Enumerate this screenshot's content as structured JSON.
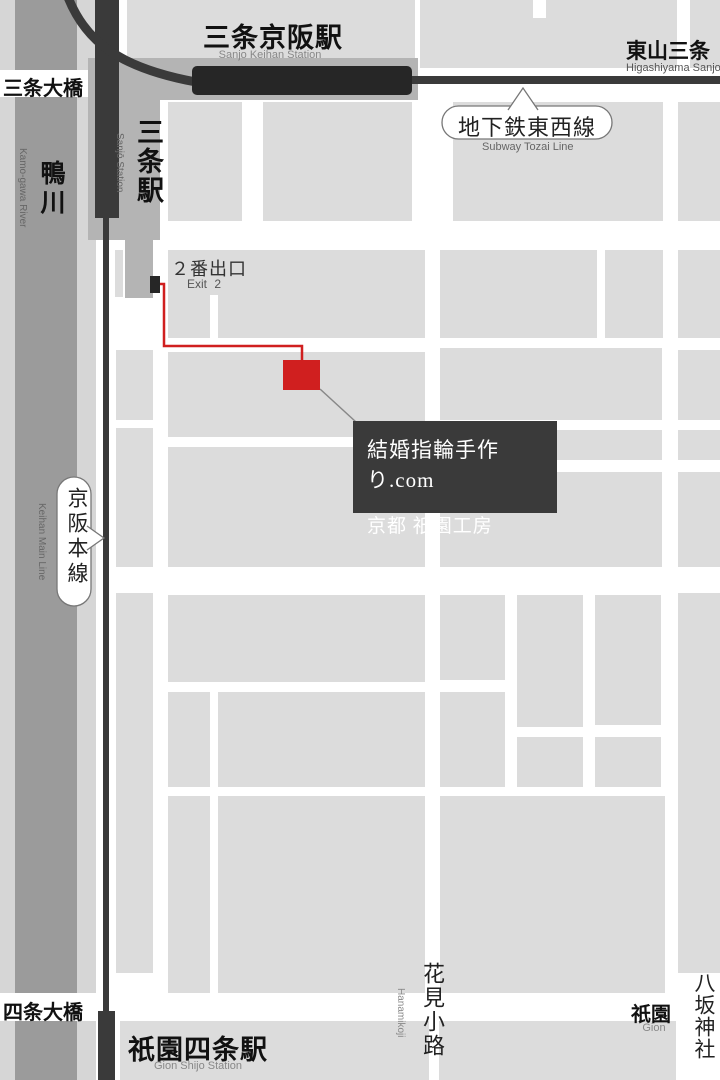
{
  "labels": {
    "sanjo_keihan_station": {
      "ja": "三条京阪駅",
      "en": "Sanjo Keihan Station"
    },
    "higashiyama_sanjo": {
      "ja": "東山三条",
      "en": "Higashiyama Sanjo"
    },
    "sanjo_ohashi_bridge": {
      "ja": "三条大橋"
    },
    "kamo_river": {
      "ja": "鴨川",
      "en": "Kamo-gawa River"
    },
    "sanjo_station": {
      "ja": "三条駅",
      "en": "Sanjō Station"
    },
    "subway_tozai_line": {
      "ja": "地下鉄東西線",
      "en": "Subway Tozai Line"
    },
    "exit_2": {
      "ja": "２番出口",
      "en": "Exit 2"
    },
    "keihan_main_line": {
      "ja": "京阪本線",
      "en": "Keihan Main Line"
    },
    "hanamikoji": {
      "ja": "花見小路",
      "en": "Hanamikoji"
    },
    "gion": {
      "ja": "祇園",
      "en": "Gion"
    },
    "yasaka_shrine": {
      "ja": "八坂神社"
    },
    "shijo_ohashi_bridge": {
      "ja": "四条大橋"
    },
    "gion_shijo_station": {
      "ja": "祇園四条駅",
      "en": "Gion Shijo Station"
    }
  },
  "shop_label": {
    "line1": "結婚指輪手作り.com",
    "line2": "京都 祇園工房"
  },
  "colors": {
    "city_block": "#dcdcdc",
    "river": "#9b9b9b",
    "riverbank": "#d6d6d6",
    "rail_line": "#3a3a3a",
    "station_platform": "#262626",
    "station_building": "#b4b4b4",
    "route_red": "#d01f1f",
    "shop_label_bg": "#3a3a3a"
  }
}
